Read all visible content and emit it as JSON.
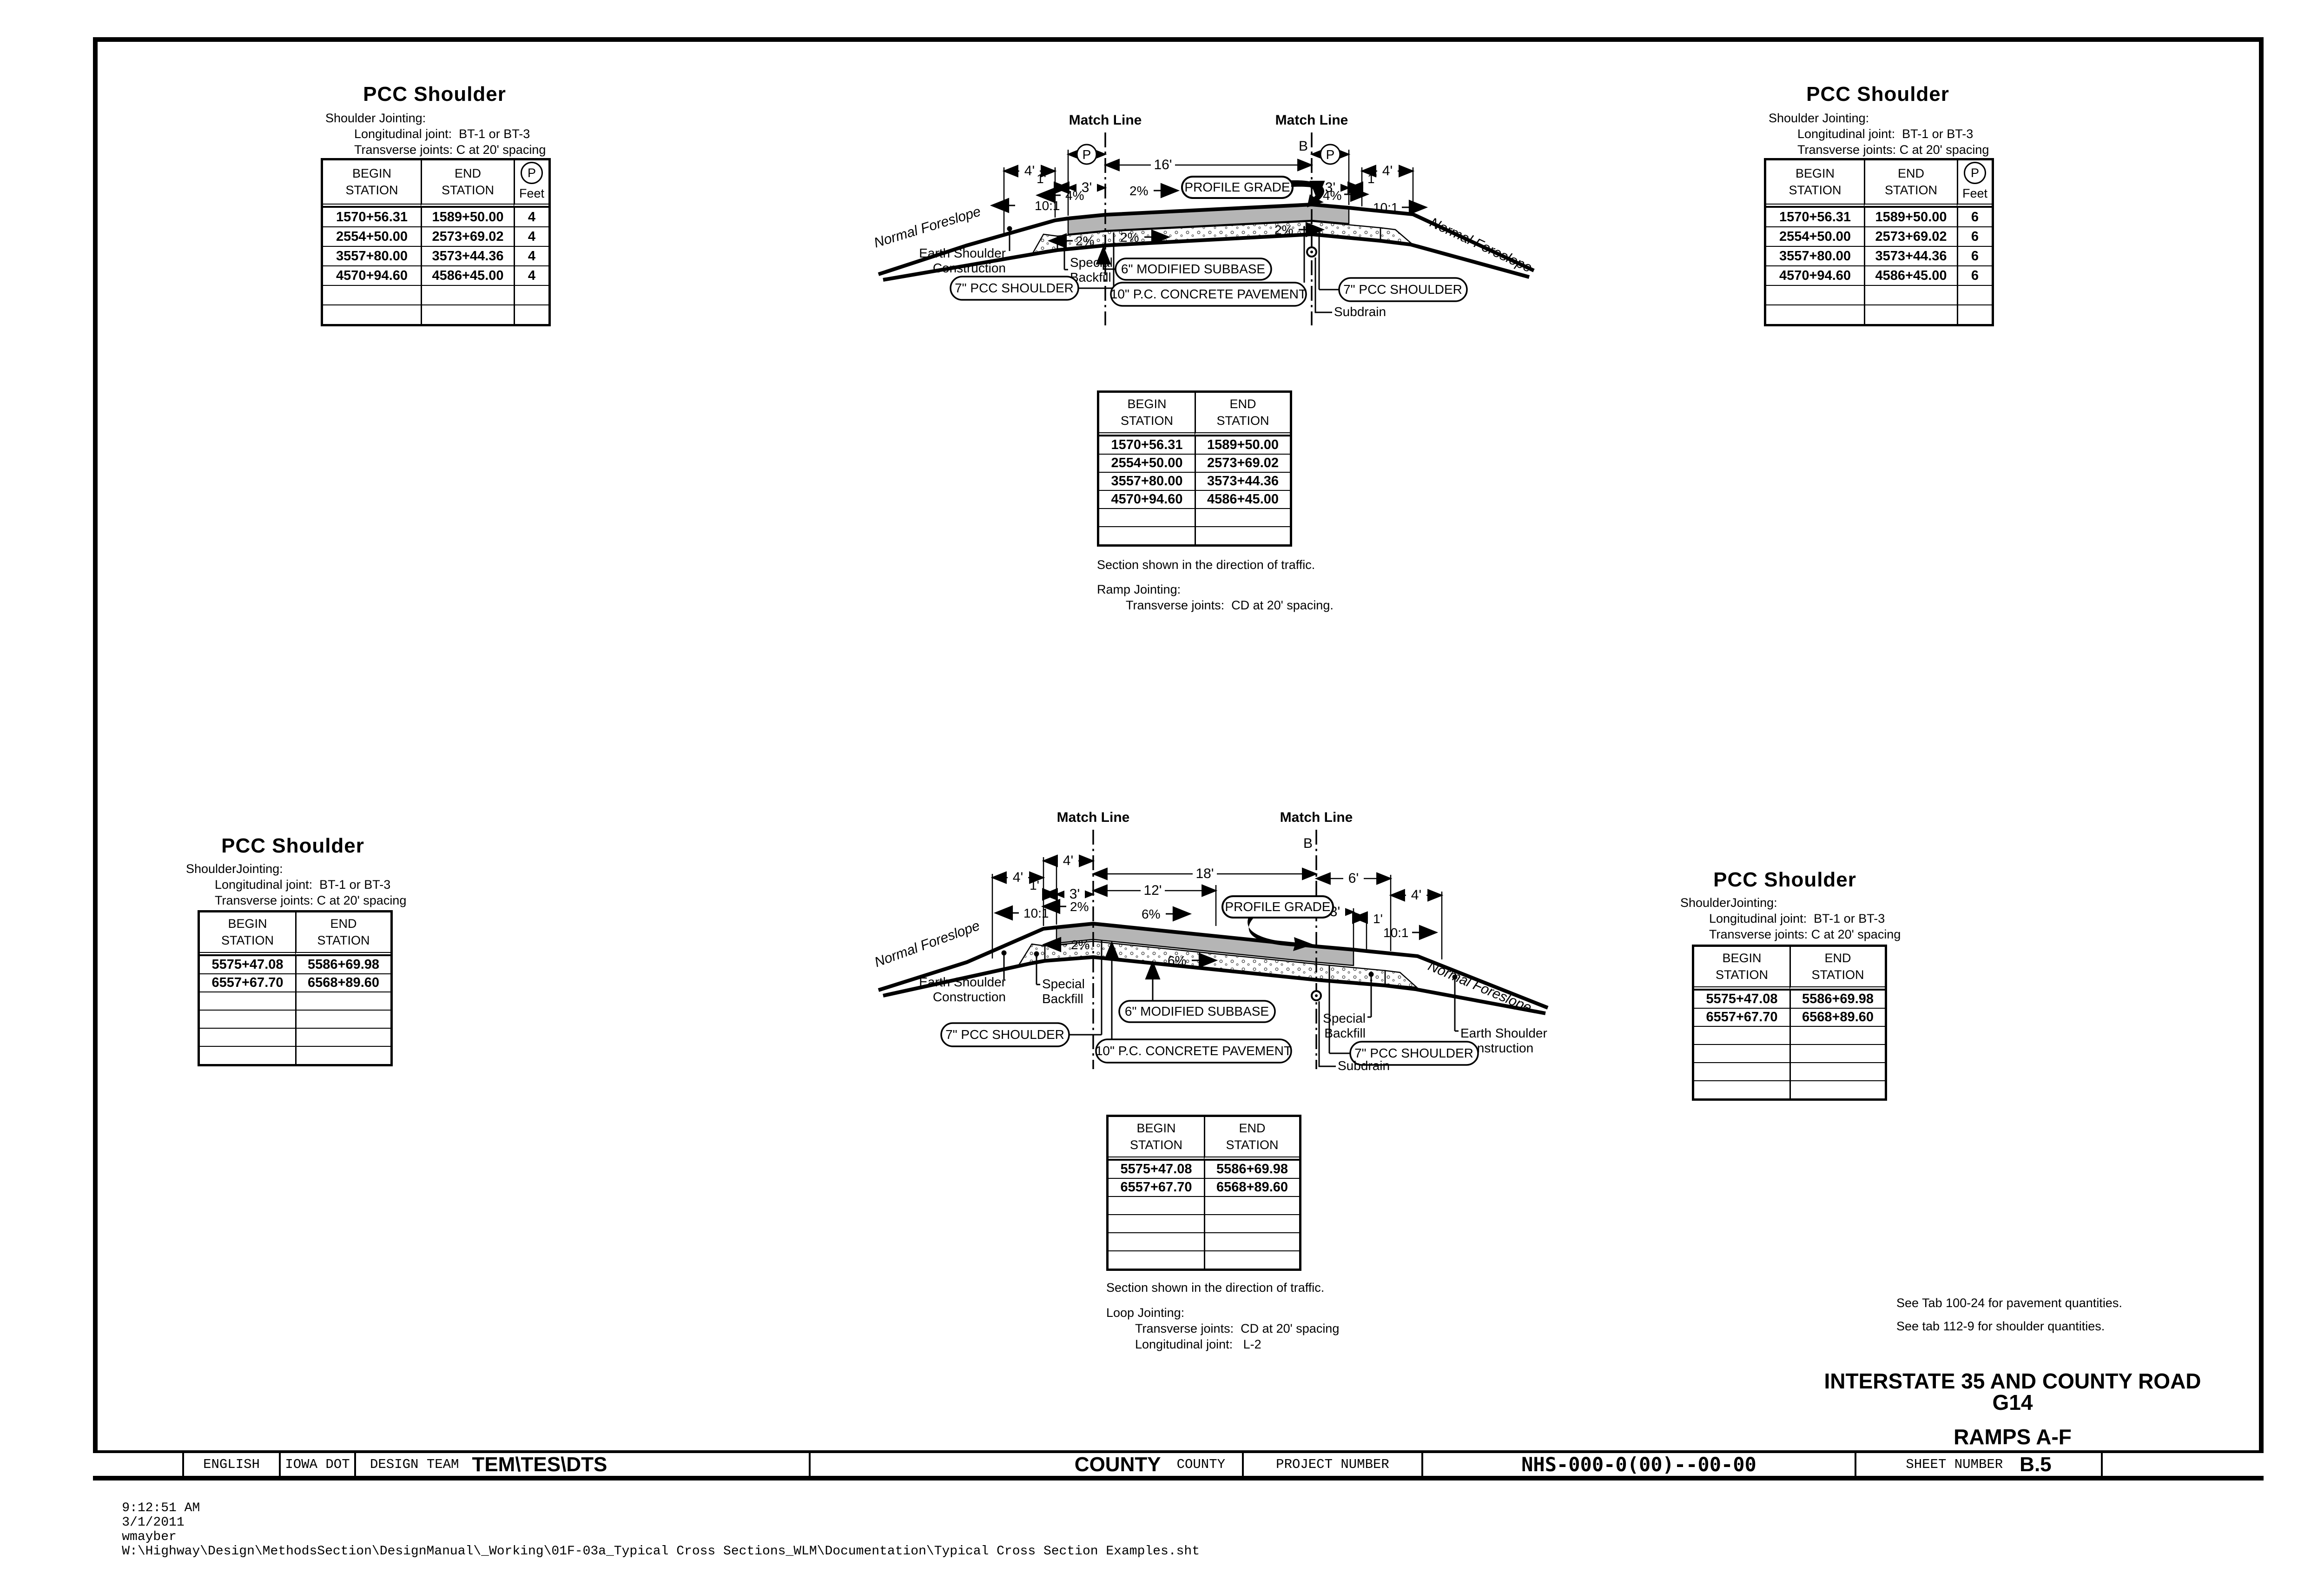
{
  "sheet": {
    "status": {
      "time": "9:12:51 AM",
      "date": "3/1/2011",
      "user": "wmayber",
      "path": "W:\\Highway\\Design\\MethodsSection\\DesignManual\\_Working\\01F-03a_Typical Cross Sections_WLM\\Documentation\\Typical Cross Section Examples.sht"
    },
    "title_block": {
      "english": "ENGLISH",
      "agency": "IOWA DOT",
      "design_team_label": "DESIGN TEAM",
      "design_team_value": "TEM\\TES\\DTS",
      "county_value": "COUNTY",
      "county_label": "COUNTY",
      "project_number_label": "PROJECT NUMBER",
      "project_number_value": "NHS-000-0(00)--00-00",
      "sheet_number_label": "SHEET NUMBER",
      "sheet_number_value": "B.5"
    },
    "main_title": {
      "line1": "INTERSTATE 35 AND COUNTY ROAD G14",
      "line2": "RAMPS A-F"
    },
    "notes": {
      "note1": "See Tab 100-24 for pavement quantities.",
      "note2": "See tab 112-9 for shoulder quantities."
    }
  },
  "blocks": {
    "top_left": {
      "title": "PCC Shoulder",
      "jointing_heading": "Shoulder Jointing:",
      "jointing_line1": "Longitudinal joint:  BT-1 or BT-3",
      "jointing_line2": "Transverse joints: C at 20' spacing",
      "header": {
        "begin1": "BEGIN",
        "begin2": "STATION",
        "end1": "END",
        "end2": "STATION",
        "p": "P",
        "feet": "Feet"
      },
      "rows": [
        {
          "begin": "1570+56.31",
          "end": "1589+50.00",
          "feet": "4"
        },
        {
          "begin": "2554+50.00",
          "end": "2573+69.02",
          "feet": "4"
        },
        {
          "begin": "3557+80.00",
          "end": "3573+44.36",
          "feet": "4"
        },
        {
          "begin": "4570+94.60",
          "end": "4586+45.00",
          "feet": "4"
        }
      ]
    },
    "top_right": {
      "title": "PCC Shoulder",
      "jointing_heading": "Shoulder Jointing:",
      "jointing_line1": "Longitudinal joint:  BT-1 or BT-3",
      "jointing_line2": "Transverse joints: C at 20' spacing",
      "header": {
        "begin1": "BEGIN",
        "begin2": "STATION",
        "end1": "END",
        "end2": "STATION",
        "p": "P",
        "feet": "Feet"
      },
      "rows": [
        {
          "begin": "1570+56.31",
          "end": "1589+50.00",
          "feet": "6"
        },
        {
          "begin": "2554+50.00",
          "end": "2573+69.02",
          "feet": "6"
        },
        {
          "begin": "3557+80.00",
          "end": "3573+44.36",
          "feet": "6"
        },
        {
          "begin": "4570+94.60",
          "end": "4586+45.00",
          "feet": "6"
        }
      ]
    },
    "bottom_left": {
      "title": "PCC Shoulder",
      "jointing_heading": "ShoulderJointing:",
      "jointing_line1": "Longitudinal joint:  BT-1 or BT-3",
      "jointing_line2": "Transverse joints: C at 20' spacing",
      "header": {
        "begin1": "BEGIN",
        "begin2": "STATION",
        "end1": "END",
        "end2": "STATION"
      },
      "rows": [
        {
          "begin": "5575+47.08",
          "end": "5586+69.98"
        },
        {
          "begin": "6557+67.70",
          "end": "6568+89.60"
        }
      ]
    },
    "bottom_right": {
      "title": "PCC Shoulder",
      "jointing_heading": "ShoulderJointing:",
      "jointing_line1": "Longitudinal joint:  BT-1 or BT-3",
      "jointing_line2": "Transverse joints: C at 20' spacing",
      "header": {
        "begin1": "BEGIN",
        "begin2": "STATION",
        "end1": "END",
        "end2": "STATION"
      },
      "rows": [
        {
          "begin": "5575+47.08",
          "end": "5586+69.98"
        },
        {
          "begin": "6557+67.70",
          "end": "6568+89.60"
        }
      ]
    }
  },
  "center_tables": {
    "ramp": {
      "header": {
        "begin1": "BEGIN",
        "begin2": "STATION",
        "end1": "END",
        "end2": "STATION"
      },
      "rows": [
        {
          "begin": "1570+56.31",
          "end": "1589+50.00"
        },
        {
          "begin": "2554+50.00",
          "end": "2573+69.02"
        },
        {
          "begin": "3557+80.00",
          "end": "3573+44.36"
        },
        {
          "begin": "4570+94.60",
          "end": "4586+45.00"
        }
      ],
      "caption": "Section shown in the direction of traffic.",
      "jointing_heading": "Ramp Jointing:",
      "jointing_line1": "Transverse joints:  CD at 20' spacing."
    },
    "loop": {
      "header": {
        "begin1": "BEGIN",
        "begin2": "STATION",
        "end1": "END",
        "end2": "STATION"
      },
      "rows": [
        {
          "begin": "5575+47.08",
          "end": "5586+69.98"
        },
        {
          "begin": "6557+67.70",
          "end": "6568+89.60"
        }
      ],
      "caption": "Section shown in the direction of traffic.",
      "jointing_heading": "Loop Jointing:",
      "jointing_line1": "Transverse joints:  CD at 20' spacing",
      "jointing_line2": "Longitudinal joint:   L-2"
    }
  },
  "diagram_top": {
    "match_line_left": "Match Line",
    "match_line_right": "Match Line",
    "b": "B",
    "p": "P",
    "dims": {
      "left_4": "4'",
      "left_1": "1'",
      "left_3": "3'",
      "center_16": "16'",
      "right_3": "3'",
      "right_1": "1'",
      "right_4": "4'"
    },
    "slopes": {
      "left_101": "10:1",
      "left_4pct": "4%",
      "top_2pct": "2%",
      "right_4pct": "4%",
      "right_101": "10:1",
      "sub_left_2pct": "2%",
      "sub_center_2pct": "2%",
      "sub_right_2pct": "2%"
    },
    "labels": {
      "profile_grade": "PROFILE GRADE",
      "normal_foreslope_left": "Normal Foreslope",
      "normal_foreslope_right": "Normal Foreslope",
      "earth_shoulder1": "Earth Shoulder",
      "earth_shoulder2": "Construction",
      "special1": "Special",
      "special2": "Backfill",
      "subbase": "6\" MODIFIED SUBBASE",
      "pcc_shoulder_left": "7\" PCC SHOULDER",
      "pcc_shoulder_right": "7\" PCC SHOULDER",
      "pavement": "10\" P.C. CONCRETE PAVEMENT",
      "subdrain": "Subdrain"
    }
  },
  "diagram_bottom": {
    "match_line_left": "Match Line",
    "match_line_right": "Match Line",
    "b": "B",
    "dims": {
      "left_4a": "4'",
      "left_4b": "4'",
      "left_1": "1'",
      "left_3": "3'",
      "center_18": "18'",
      "center_12": "12'",
      "right_6": "6'",
      "right_4": "4'",
      "right_3": "3'",
      "right_1": "1'"
    },
    "slopes": {
      "left_2pct": "2%",
      "left_101": "10:1",
      "top_6pct": "6%",
      "sub_6pct": "6%",
      "sub_left_2pct": "2%",
      "right_101": "10:1"
    },
    "labels": {
      "profile_grade": "PROFILE GRADE",
      "normal_foreslope_left": "Normal Foreslope",
      "normal_foreslope_right": "Normal Foreslope",
      "earth_shoulder1": "Earth Shoulder",
      "earth_shoulder2": "Construction",
      "special1": "Special",
      "special2": "Backfill",
      "subbase": "6\" MODIFIED SUBBASE",
      "pcc_shoulder_left": "7\" PCC SHOULDER",
      "pcc_shoulder_right": "7\" PCC SHOULDER",
      "pavement": "10\" P.C. CONCRETE PAVEMENT",
      "subdrain": "Subdrain"
    }
  }
}
